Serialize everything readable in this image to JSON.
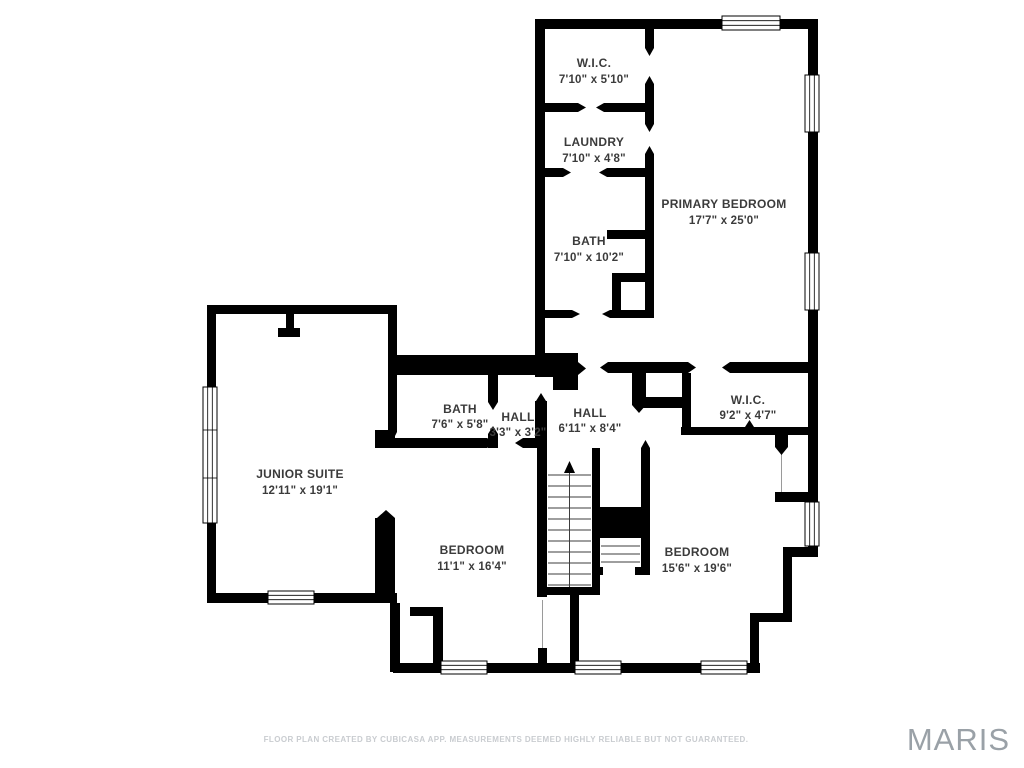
{
  "plan": {
    "creator_note": "FLOOR PLAN CREATED BY CUBICASA APP. MEASUREMENTS DEEMED HIGHLY RELIABLE BUT NOT GUARANTEED.",
    "logo": "MARIS",
    "colors": {
      "walls": "#000000",
      "background": "#ffffff",
      "label_text": "#3b3b3b",
      "footer_text": "#c9ccd0",
      "logo_text": "#9aa1a7"
    }
  },
  "rooms": {
    "wic_top": {
      "name": "W.I.C.",
      "dims": "7'10\" x 5'10\""
    },
    "laundry": {
      "name": "LAUNDRY",
      "dims": "7'10\" x 4'8\""
    },
    "bath_top": {
      "name": "BATH",
      "dims": "7'10\" x 10'2\""
    },
    "primary_bedroom": {
      "name": "PRIMARY BEDROOM",
      "dims": "17'7\" x 25'0\""
    },
    "junior_suite": {
      "name": "JUNIOR SUITE",
      "dims": "12'11\" x 19'1\""
    },
    "bath_mid": {
      "name": "BATH",
      "dims": "7'6\" x 5'8\""
    },
    "hall_small": {
      "name": "HALL",
      "dims": "3'3\" x 3'2\""
    },
    "hall_main": {
      "name": "HALL",
      "dims": "6'11\" x 8'4\""
    },
    "wic_right": {
      "name": "W.I.C.",
      "dims": "9'2\" x 4'7\""
    },
    "bedroom_left": {
      "name": "BEDROOM",
      "dims": "11'1\" x 16'4\""
    },
    "bedroom_right": {
      "name": "BEDROOM",
      "dims": "15'6\" x 19'6\""
    }
  }
}
